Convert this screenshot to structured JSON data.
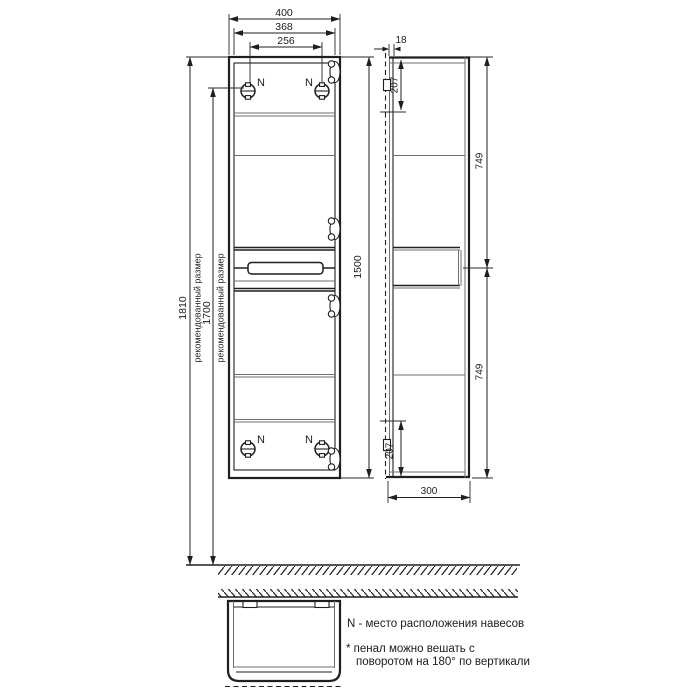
{
  "drawing": {
    "hanger_mark": "N",
    "front": {
      "width": "400",
      "inner_width": "368",
      "hanger_spacing": "256",
      "height": "1500"
    },
    "mounting": {
      "h1": "1810",
      "h1_label": "рекомендованный размер",
      "h2": "1700",
      "h2_label": "рекомендованный размер"
    },
    "side": {
      "back_gap": "18",
      "top_hanger_offset": "207",
      "upper_section": "749",
      "lower_section": "749",
      "bottom_hanger_offset": "207",
      "depth": "300"
    },
    "notes": {
      "legend": "N - место расположения навесов",
      "note1": "* пенал можно вешать с",
      "note2": "поворотом на 180° по вертикали"
    }
  }
}
